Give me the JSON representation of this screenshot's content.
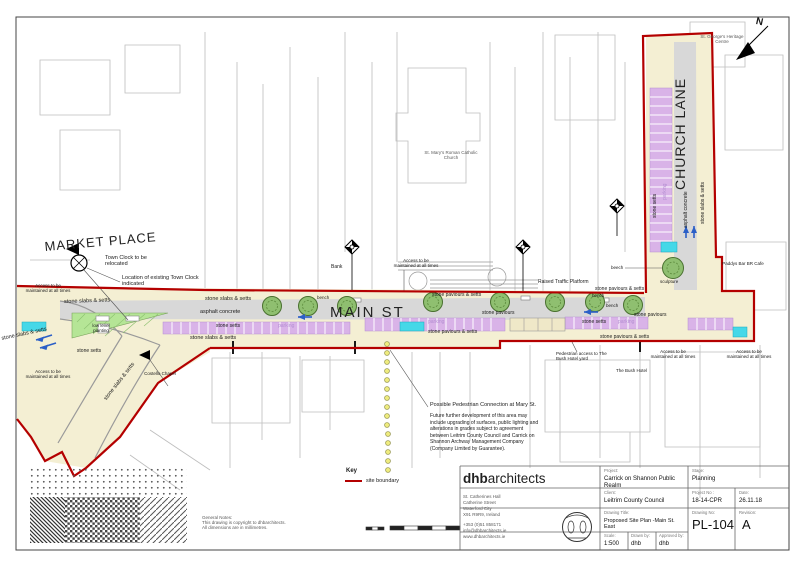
{
  "north_label": "N",
  "streets": {
    "market_place": "MARKET PLACE",
    "main_st": "MAIN ST",
    "church_lane": "CHURCH LANE"
  },
  "surfaces": {
    "stone_slabs_setts": "stone slabs & setts",
    "stone_setts": "stone setts",
    "stone_paviours_setts": "stone paviours & setts",
    "stone_paviours": "stone paviours",
    "asphalt_concrete": "asphalt concrete",
    "parking": "parking",
    "low_level_planting": "low level planting",
    "bench": "bench",
    "beech": "beech",
    "sculpture": "sculpture"
  },
  "annotations": {
    "access": "Access to be maintained at all times",
    "town_clock_relocated": "Town Clock to be relocated",
    "town_clock_existing": "Location of existing Town Clock indicated",
    "raised_traffic_platform": "Raised Traffic Platform",
    "ped_access_bush": "Pedestrian access to The Bush Hotel yard",
    "ped_connection": "Possible Pedestrian Connection at Mary St.",
    "future_note": "Future further development of this area may include upgrading of surfaces, public lighting and alterations in grades subject to agreement between Leitrim County Council and Carrick on Shannon Archway Management Company (Company Limited by Guarantee)."
  },
  "places": {
    "bank": "Bank",
    "costello_chapel": "Costello Chapel",
    "st_marys": "St. Mary's Roman Catholic Church",
    "st_georges": "St. George's Heritage Centre",
    "paddys": "Paddys Bar BR Cafe",
    "bush_hotel": "The Bush Hotel"
  },
  "key": {
    "title": "Key",
    "site_boundary": "site boundary"
  },
  "general_notes": "General Notes:\nThis drawing is copyright to dhbarchitects.\nAll dimensions are in millimetres.",
  "title_block": {
    "brand_bold": "dhb",
    "brand_rest": "architects",
    "address": "St. Catherines Hall\nCatherine Street\nWaterford City\nX91 R9R9, Ireland",
    "contact": "+353 (0)51 858171\ninfo@dhbarchitects.ie\nwww.dhbarchitects.ie",
    "fields": {
      "project_label": "Project:",
      "project": "Carrick on Shannon Public Realm",
      "stage_label": "Stage:",
      "stage": "Planning",
      "client_label": "Client:",
      "client": "Leitrim County Council",
      "project_no_label": "Project No :",
      "project_no": "18-14-CPR",
      "date_label": "Date:",
      "date": "26.11.18",
      "drawing_title_label": "Drawing Title:",
      "drawing_title": "Proposed Site Plan -Main St. East",
      "drawing_no_label": "Drawing No:",
      "drawing_no": "PL-104",
      "revision_label": "Revision:",
      "revision": "A",
      "scale_label": "Scale:",
      "scale": "1:500",
      "drawn_label": "Drawn by:",
      "drawn": "dhb",
      "approved_label": "Approved by:",
      "approved": "dhb"
    }
  },
  "colors": {
    "site_boundary_red": "#b40000",
    "footpath_beige": "#f4efd3",
    "asphalt_grey": "#d8d8d8",
    "parking_purple": "#d9b3e8",
    "accessible_bay_cyan": "#45d8e8",
    "tree_green": "#8fbf70",
    "planting_green": "#b5e596",
    "dotted_line_yellow": "#efec7e"
  }
}
